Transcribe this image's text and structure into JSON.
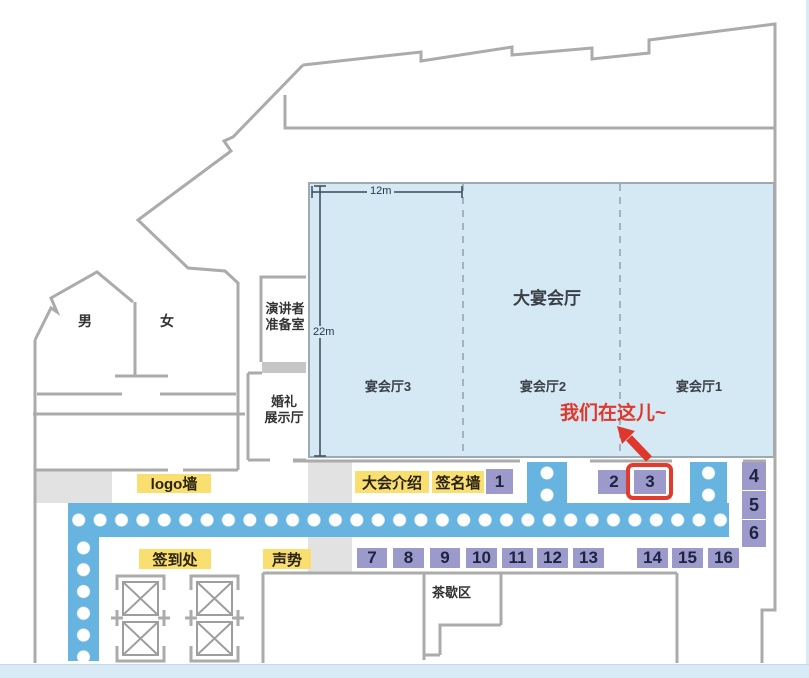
{
  "hall": {
    "title": "大宴会厅",
    "sections": [
      "宴会厅3",
      "宴会厅2",
      "宴会厅1"
    ],
    "width_label": "12m",
    "height_label": "22m"
  },
  "rooms": {
    "men": "男",
    "women": "女",
    "speaker_prep_line1": "演讲者",
    "speaker_prep_line2": "准备室",
    "wedding_line1": "婚礼",
    "wedding_line2": "展示厅",
    "tea_break": "茶歇区"
  },
  "labels": {
    "logo_wall": "logo墙",
    "conference_intro": "大会介绍",
    "signature_wall": "签名墙",
    "check_in": "签到处",
    "sound": "声势"
  },
  "booths": [
    "1",
    "2",
    "3",
    "4",
    "5",
    "6",
    "7",
    "8",
    "9",
    "10",
    "11",
    "12",
    "13",
    "14",
    "15",
    "16"
  ],
  "callout": {
    "text": "我们在这儿~",
    "highlighted_booth": "3"
  },
  "colors": {
    "corridor_blue": "#68B4E1",
    "hall_fill": "#D5E9F4",
    "booth_purple": "#9C9ACB",
    "label_yellow": "#F8DF70",
    "highlight_red": "#E23B2E",
    "wall_gray": "#ABABAB"
  }
}
